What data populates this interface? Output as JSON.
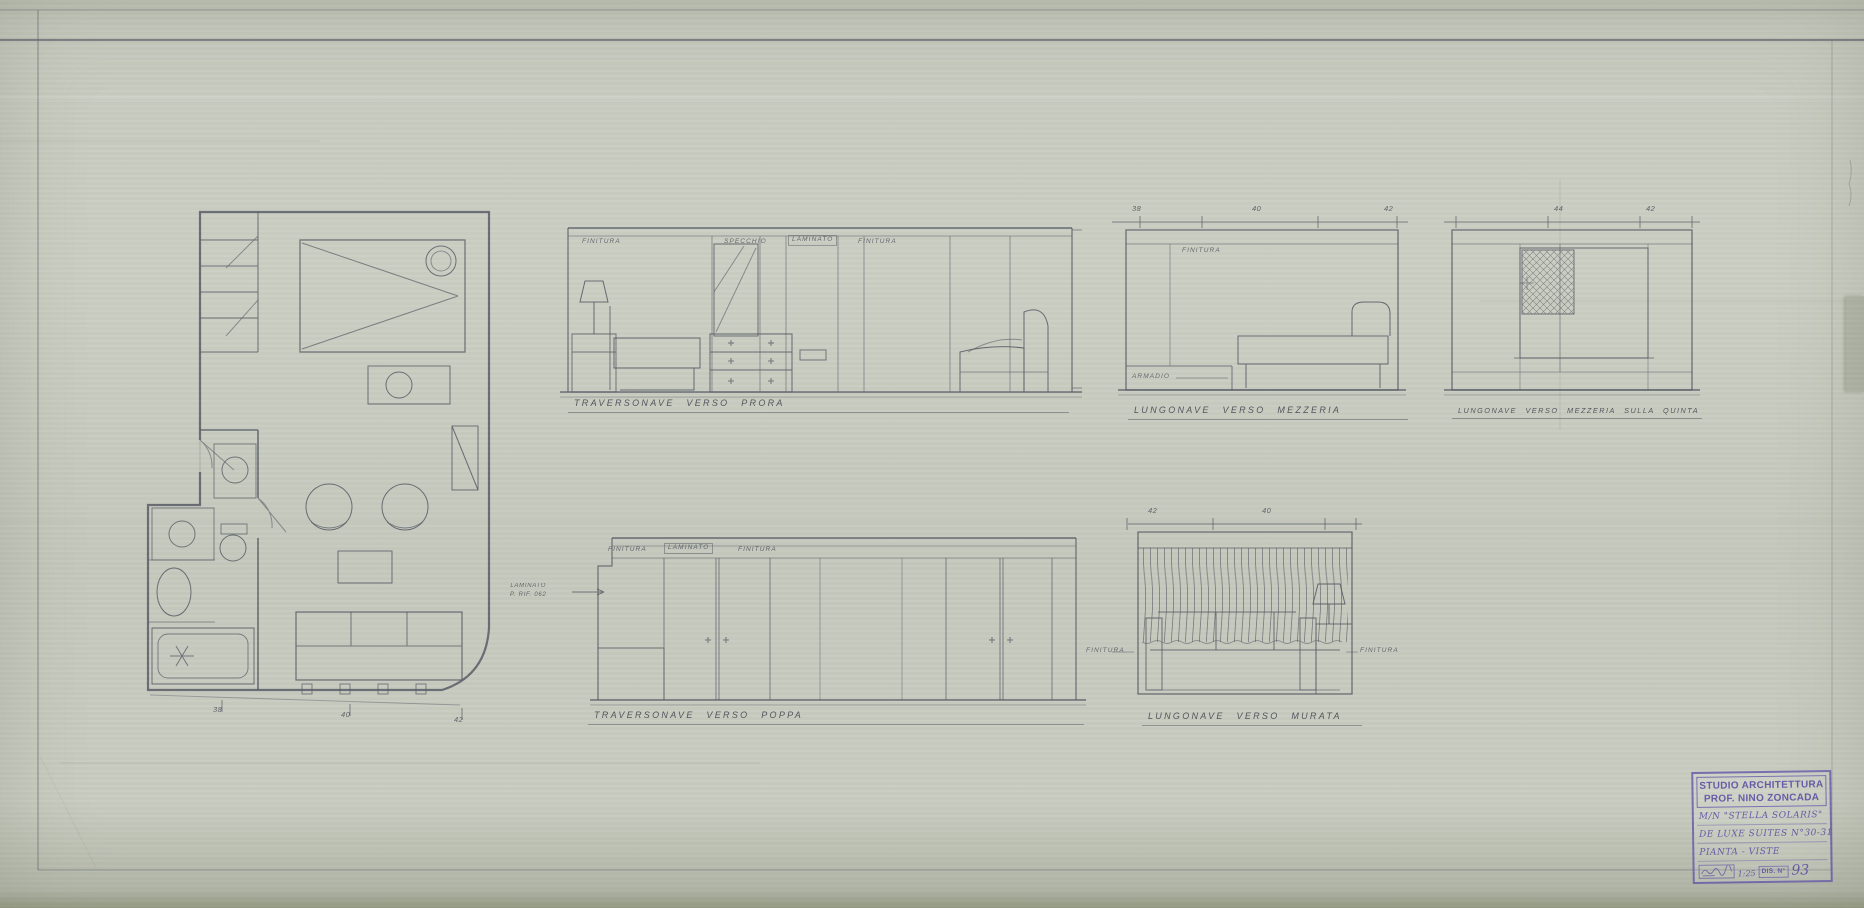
{
  "colors": {
    "paper": "#c7cbbf",
    "ink": "#565b65",
    "stamp": "#675bab"
  },
  "plan": {
    "frames": [
      "38",
      "40",
      "42"
    ]
  },
  "views": {
    "prora": {
      "caption": "TRAVERSONAVE VERSO PRORA",
      "labels": {
        "l1": "FINITURA",
        "l2": "SPECCHIO",
        "l3": "LAMINATO",
        "l4": "FINITURA"
      }
    },
    "mezzeria": {
      "caption": "LUNGONAVE VERSO MEZZERIA",
      "frames": [
        "38",
        "40",
        "42"
      ],
      "finitura": "FINITURA",
      "armadio": "ARMADIO"
    },
    "quinta": {
      "caption": "LUNGONAVE VERSO MEZZERIA SULLA QUINTA",
      "frames": [
        "44",
        "42"
      ]
    },
    "poppa": {
      "caption": "TRAVERSONAVE VERSO POPPA",
      "labels": {
        "l1": "FINITURA",
        "l2": "LAMINATO",
        "l3": "FINITURA"
      },
      "note_line1": "LAMINATO",
      "note_line2": "P. RIF. 062"
    },
    "murata": {
      "caption": "LUNGONAVE VERSO MURATA",
      "frames": [
        "42",
        "40"
      ],
      "label_left": "FINITURA",
      "label_right": "FINITURA"
    }
  },
  "title_block": {
    "studio_line1": "STUDIO ARCHITETTURA",
    "studio_line2": "PROF. NINO ZONCADA",
    "ship": "M/N \"STELLA SOLARIS\"",
    "subject": "DE LUXE SUITES N°30-31",
    "content": "PIANTA - VISTE",
    "scale": "1:25",
    "dis_label": "DIS. N°",
    "dis_number": "93"
  }
}
